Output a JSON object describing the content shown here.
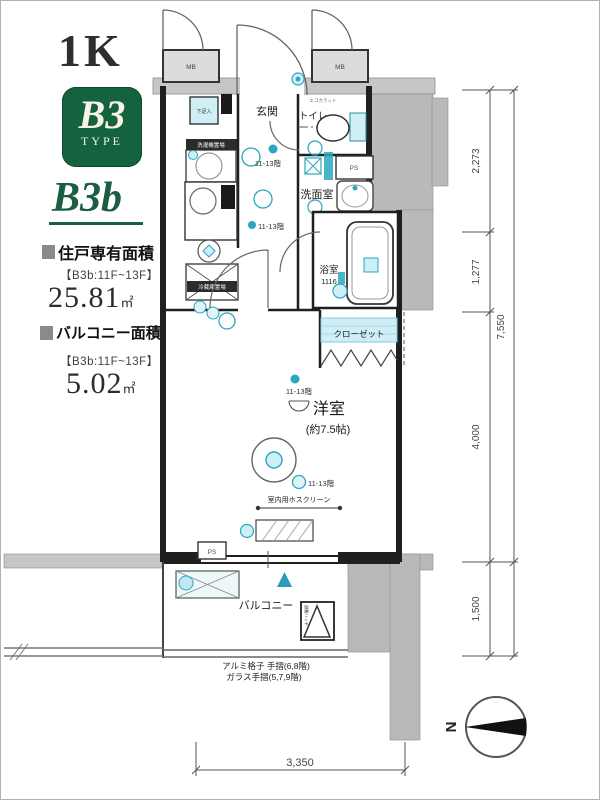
{
  "panel": {
    "title": "1K",
    "badge_code": "B3",
    "badge_sub": "TYPE",
    "plan_name": "B3b",
    "area1_label": "住戸専有面積",
    "area1_range": "【B3b:11F~13F】",
    "area1_value": "25.81",
    "area1_unit": "㎡",
    "area2_label": "バルコニー面積",
    "area2_range": "【B3b:11F~13F】",
    "area2_value": "5.02",
    "area2_unit": "㎡"
  },
  "plan": {
    "rooms": {
      "entrance": "玄関",
      "toilet": "トイレ",
      "washroom": "洗面室",
      "bathroom": "浴室",
      "bathroom_size": "1116",
      "closet": "クローゼット",
      "living": "洋室",
      "living_size": "(約7.5帖)",
      "balcony": "バルコニー",
      "shoebox": "下足入",
      "meter_box": "MB",
      "pipe_space": "PS"
    },
    "fixture_labels": {
      "washer": "洗濯機置場",
      "fridge": "冷蔵庫置場",
      "wall_panel": "エコカラット",
      "hatch": "避難ハッチ"
    },
    "floor_note": "11-13階",
    "screen_note": "室内用ホスクリーン",
    "rail_note1": "アルミ格子 手摺(6,8階)",
    "rail_note2": "ガラス手摺(5,7,9階)"
  },
  "dimensions": {
    "right_segments": [
      "2,273",
      "1,277",
      "4,000",
      "1,500"
    ],
    "right_total": "7,550",
    "bottom_width": "3,350"
  },
  "compass": {
    "north_label": "N"
  },
  "colors": {
    "accent_green": "#14623e",
    "teal": "#2aa8bf",
    "teal_light": "#cfeef6",
    "block_gray": "#b9b9b9",
    "wall": "#1f1f1f"
  }
}
